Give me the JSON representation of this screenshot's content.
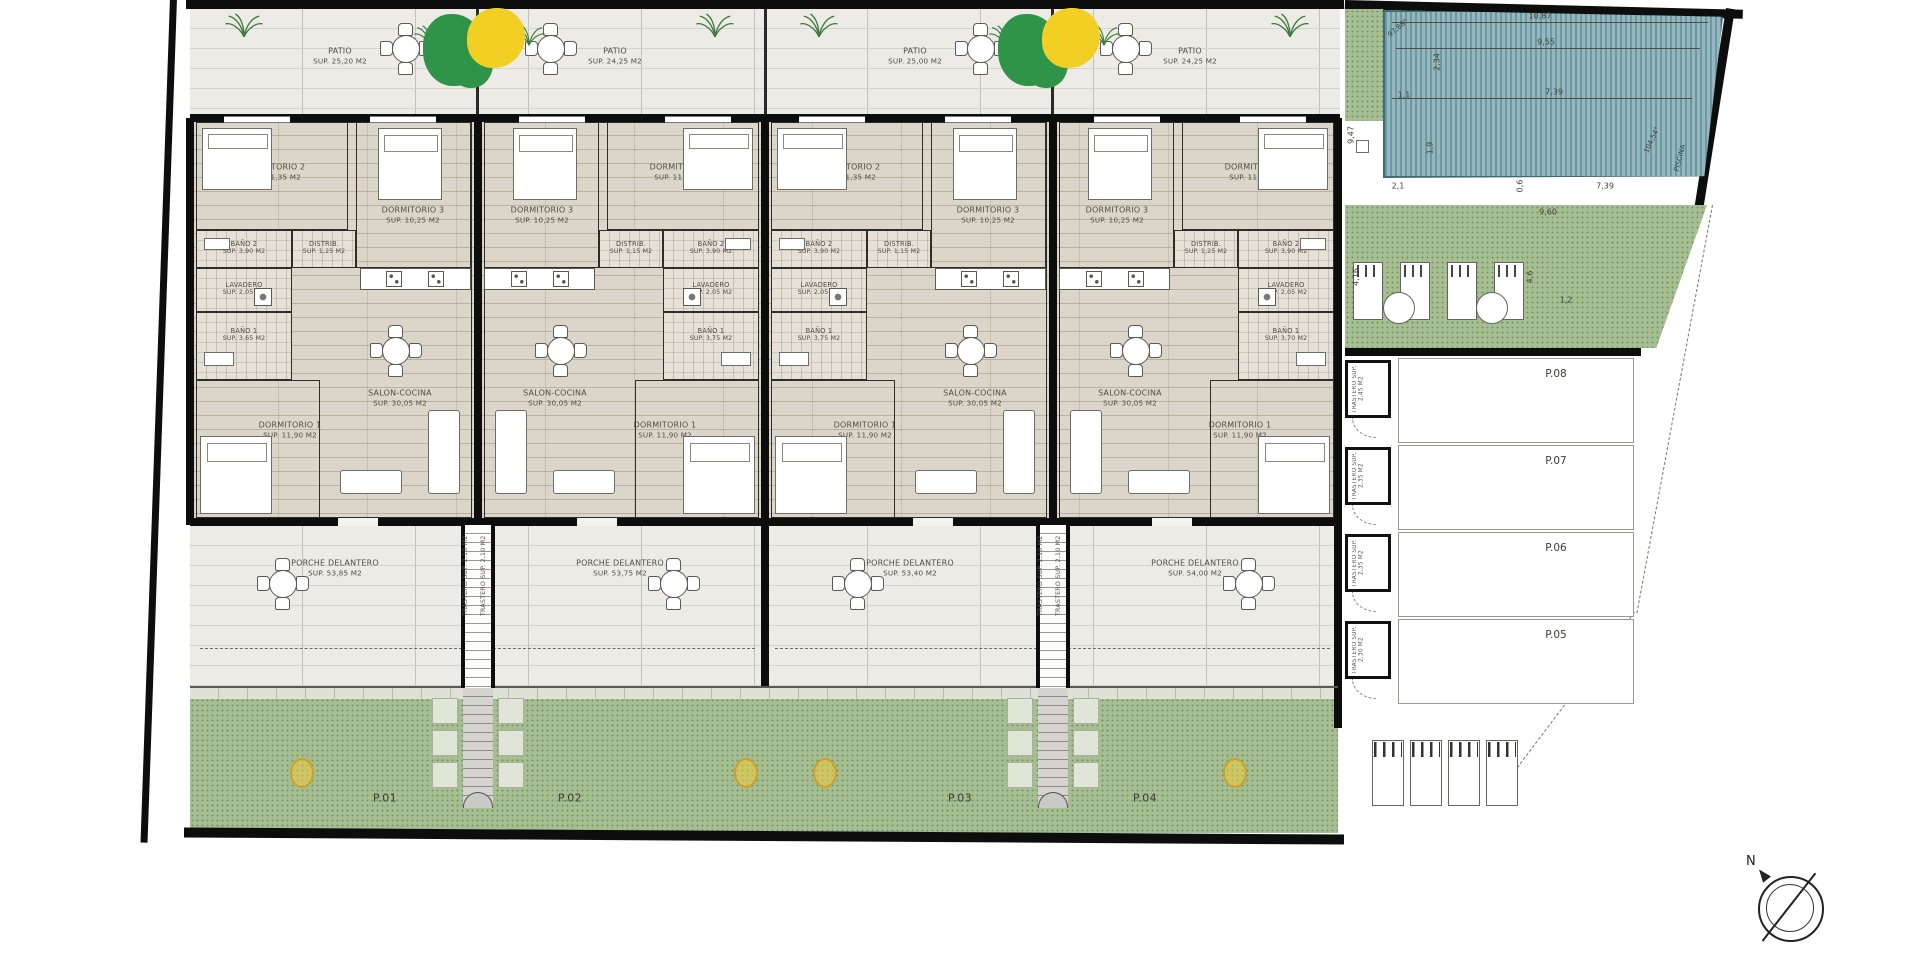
{
  "room_names": {
    "patio": "PATIO",
    "dorm2": "DORMITORIO 2",
    "dorm3": "DORMITORIO 3",
    "bano2": "BAÑO 2",
    "distrib": "DISTRIB.",
    "lavadero": "LAVADERO",
    "bano1": "BAÑO 1",
    "dorm1": "DORMITORIO 1",
    "salon": "SALON-COCINA",
    "porche": "PORCHE DELANTERO",
    "trastero": "TRASTERO"
  },
  "units": [
    {
      "plot": "P.01",
      "patio": "SUP. 25,20 M2",
      "dorm2": "SUP. 11,35 M2",
      "dorm3": "SUP. 10,25 M2",
      "bano2": "SUP. 3,90 M2",
      "distrib": "SUP. 1,25 M2",
      "lavadero": "SUP. 2,05 M2",
      "bano1": "SUP. 3,65 M2",
      "dorm1": "SUP. 11,90 M2",
      "salon": "SUP. 30,05 M2",
      "porche": "SUP. 53,85 M2",
      "trastero": "SUP. 2,10 M2"
    },
    {
      "plot": "P.02",
      "patio": "SUP. 24,25 M2",
      "dorm2": "SUP. 11,35 M2",
      "dorm3": "SUP. 10,25 M2",
      "bano2": "SUP. 3,90 M2",
      "distrib": "SUP. 1,15 M2",
      "lavadero": "SUP. 2,05 M2",
      "bano1": "SUP. 3,75 M2",
      "dorm1": "SUP. 11,90 M2",
      "salon": "SUP. 30,05 M2",
      "porche": "SUP. 53,75 M2",
      "trastero": "SUP. 2,10 M2"
    },
    {
      "plot": "P.03",
      "patio": "SUP. 25,00 M2",
      "dorm2": "SUP. 11,35 M2",
      "dorm3": "SUP. 10,25 M2",
      "bano2": "SUP. 3,90 M2",
      "distrib": "SUP. 1,15 M2",
      "lavadero": "SUP. 2,05 M2",
      "bano1": "SUP. 3,75 M2",
      "dorm1": "SUP. 11,90 M2",
      "salon": "SUP. 30,05 M2",
      "porche": "SUP. 53,40 M2",
      "trastero": "SUP. 2,10 M2"
    },
    {
      "plot": "P.04",
      "patio": "SUP. 24,25 M2",
      "dorm2": "SUP. 11,35 M2",
      "dorm3": "SUP. 10,25 M2",
      "bano2": "SUP. 3,90 M2",
      "distrib": "SUP. 1,25 M2",
      "lavadero": "SUP. 2,05 M2",
      "bano1": "SUP. 3,70 M2",
      "dorm1": "SUP. 11,90 M2",
      "salon": "SUP. 30,05 M2",
      "porche": "SUP. 54,00 M2",
      "trastero": "SUP. 2,10 M2"
    }
  ],
  "pool": {
    "label": "PISCINA",
    "dims": [
      "10,87",
      "9,55",
      "7,39",
      "2,34",
      "1,1",
      "1,9",
      "9,47",
      "2,1",
      "0,6",
      "7,39",
      "9,60",
      "4,6",
      "4,16",
      "1,2"
    ],
    "angles": [
      "97,88°",
      "104,54°"
    ]
  },
  "parking": {
    "trastero_label": "TRASTERO",
    "bays": [
      {
        "label": "P.08",
        "trastero_sup": "SUP. 2,45 M2"
      },
      {
        "label": "P.07",
        "trastero_sup": "SUP. 2,35 M2"
      },
      {
        "label": "P.06",
        "trastero_sup": "SUP. 2,35 M2"
      },
      {
        "label": "P.05",
        "trastero_sup": "SUP. 2,30 M2"
      }
    ]
  },
  "compass": {
    "north_label": "N"
  },
  "colors": {
    "garden_green": "#a6bf92",
    "pool_teal": "#6d98a3",
    "tree_green": "#2f9448",
    "tree_yellow": "#f2cf23",
    "wall_black": "#0d0d0d",
    "paving": "#edebe5"
  }
}
